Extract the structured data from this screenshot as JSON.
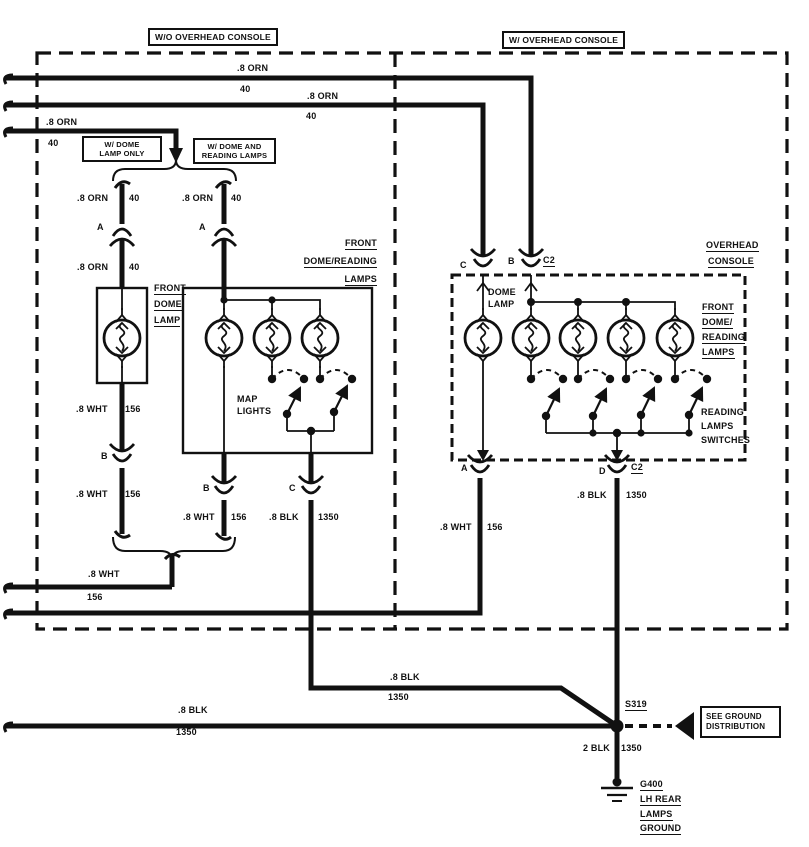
{
  "regions": {
    "without_overhead_console": "W/O OVERHEAD CONSOLE",
    "with_overhead_console": "W/ OVERHEAD CONSOLE"
  },
  "option_labels": {
    "dome_lamp_only": [
      "W/ DOME",
      "LAMP ONLY"
    ],
    "dome_and_reading": [
      "W/ DOME AND",
      "READING LAMPS"
    ]
  },
  "components": {
    "front_dome_lamp": [
      "FRONT",
      "DOME",
      "LAMP"
    ],
    "front_dome_reading_lamps_left": [
      "FRONT",
      "DOME/READING",
      "LAMPS"
    ],
    "map_lights": [
      "MAP",
      "LIGHTS"
    ],
    "overhead_console": [
      "OVERHEAD",
      "CONSOLE"
    ],
    "dome_lamp": [
      "DOME",
      "LAMP"
    ],
    "front_dome_reading_lamps_right": [
      "FRONT",
      "DOME/",
      "READING",
      "LAMPS"
    ],
    "reading_lamps_switches": [
      "READING",
      "LAMPS",
      "SWITCHES"
    ]
  },
  "connector_pins": {
    "a_left": "A",
    "a_mid": "A",
    "b_left": "B",
    "b_mid": "B",
    "c_mid": "C",
    "c_top": "C",
    "b_top": "B",
    "c2_top": "C2",
    "a_overhead": "A",
    "d_overhead": "D",
    "c2_bottom": "C2"
  },
  "wires": {
    "orn_feed_1": {
      "gauge_color": ".8 ORN",
      "circuit": "40"
    },
    "orn_feed_2": {
      "gauge_color": ".8 ORN",
      "circuit": "40"
    },
    "orn_feed_3": {
      "gauge_color": ".8 ORN",
      "circuit": "40"
    },
    "orn_branch_left_upper": {
      "gauge_color": ".8 ORN",
      "circuit": "40"
    },
    "orn_branch_right": {
      "gauge_color": ".8 ORN",
      "circuit": "40"
    },
    "orn_branch_left_lower": {
      "gauge_color": ".8 ORN",
      "circuit": "40"
    },
    "wht_dome_upper": {
      "gauge_color": ".8 WHT",
      "circuit": "156"
    },
    "wht_dome_lower": {
      "gauge_color": ".8 WHT",
      "circuit": "156"
    },
    "wht_reading": {
      "gauge_color": ".8 WHT",
      "circuit": "156"
    },
    "blk_reading": {
      "gauge_color": ".8 BLK",
      "circuit": "1350"
    },
    "wht_return_left": {
      "gauge_color": ".8 WHT",
      "circuit": "156"
    },
    "wht_overhead_return": {
      "gauge_color": ".8 WHT",
      "circuit": "156"
    },
    "blk_overhead": {
      "gauge_color": ".8 BLK",
      "circuit": "1350"
    },
    "blk_branch": {
      "gauge_color": ".8 BLK",
      "circuit": "1350"
    },
    "blk_main": {
      "gauge_color": ".8 BLK",
      "circuit": "1350"
    },
    "blk_ground": {
      "gauge_color": "2 BLK",
      "circuit": "1350"
    }
  },
  "ground": {
    "splice": "S319",
    "reference": [
      "SEE GROUND",
      "DISTRIBUTION"
    ],
    "ground_labels": [
      "G400",
      "LH REAR",
      "LAMPS",
      "GROUND"
    ]
  },
  "colors": {
    "ink": "#111111",
    "background": "#ffffff"
  }
}
